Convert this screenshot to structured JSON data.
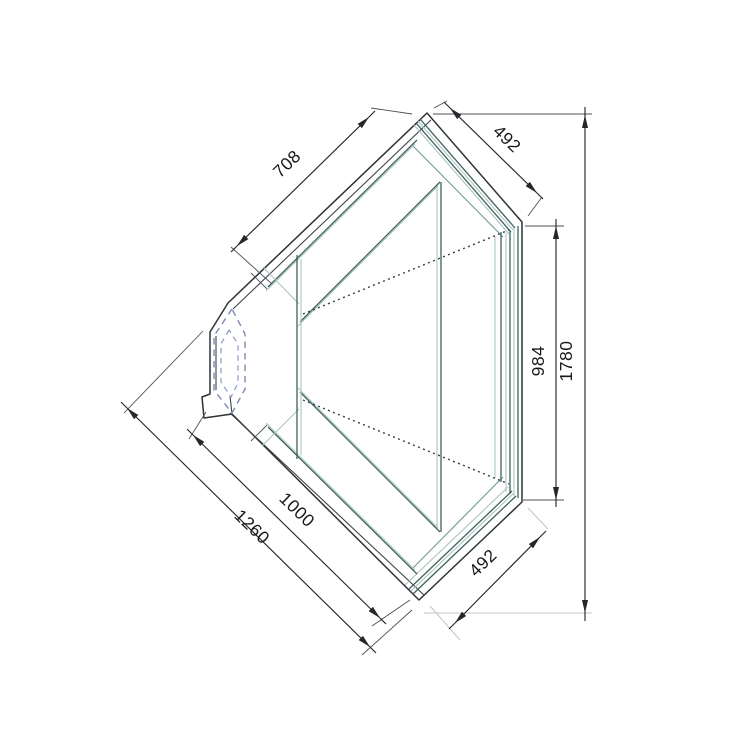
{
  "drawing": {
    "description": "Plan-view CAD dimension drawing of a 45-degree corner display counter with glass front",
    "units": "mm"
  },
  "dimensions": {
    "top_left_edge": {
      "label": "708"
    },
    "top_right_edge": {
      "label": "492"
    },
    "right_inner": {
      "label": "984"
    },
    "overall_height": {
      "label": "1780"
    },
    "bottom_left_inner": {
      "label": "1000"
    },
    "bottom_left_edge": {
      "label": "1260"
    },
    "bottom_right_edge": {
      "label": "492"
    }
  },
  "colors": {
    "line": "#2e3338",
    "glass": "#3f615b",
    "glass_light": "#a9c6c1",
    "hidden": "#7e8ab2",
    "dim": "#24282c"
  }
}
